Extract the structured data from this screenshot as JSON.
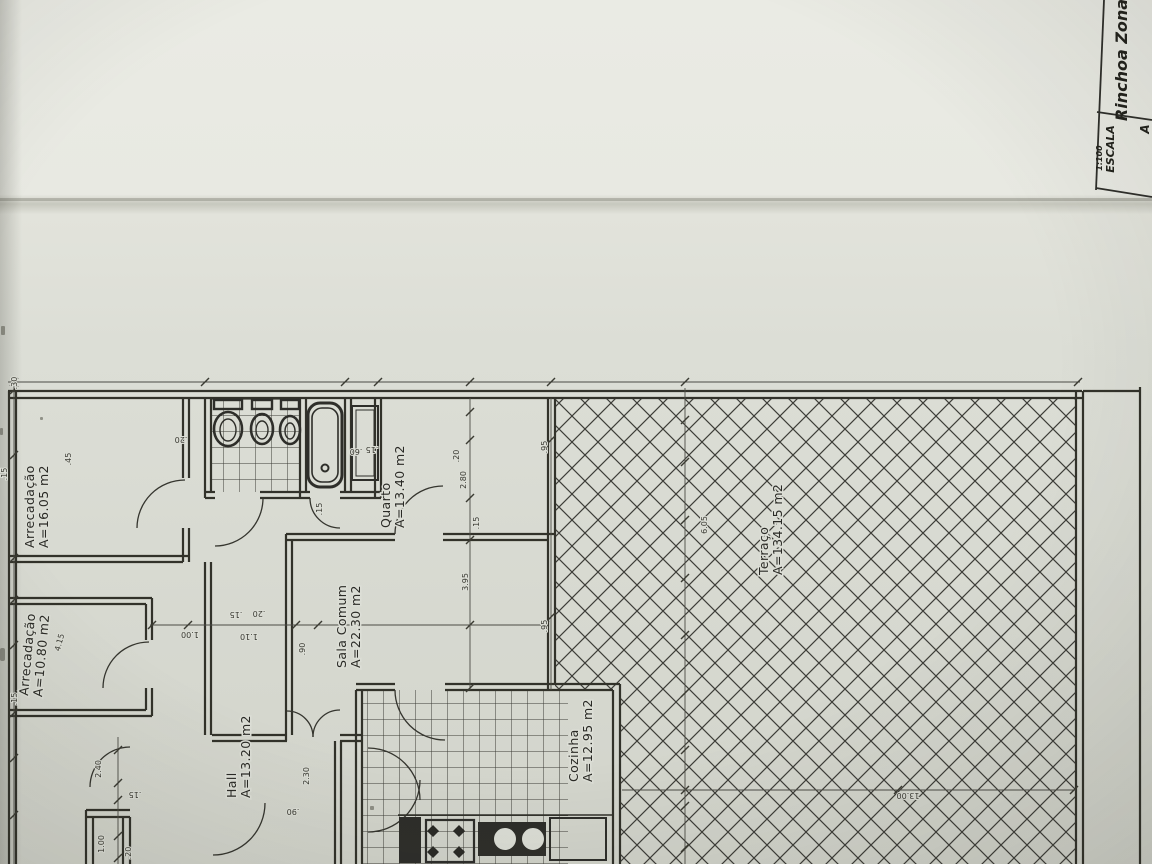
{
  "title_block": {
    "scale_label": "ESCALA",
    "scale_value": "1:100",
    "location": "Rinchoa Zona",
    "adjacent_text": "A"
  },
  "rooms": [
    {
      "name": "Arrecadação",
      "area": "A=16.05 m2",
      "x": 34,
      "y": 548,
      "r": -90
    },
    {
      "name": "Arrecadação",
      "area": "A=10.80 m2",
      "x": 28,
      "y": 696,
      "r": -85
    },
    {
      "name": "Hall",
      "area": "A=13.20 m2",
      "x": 236,
      "y": 798,
      "r": -90
    },
    {
      "name": "Sala Comum",
      "area": "A=22.30 m2",
      "x": 346,
      "y": 668,
      "r": -90
    },
    {
      "name": "Quarto",
      "area": "A=13.40 m2",
      "x": 390,
      "y": 528,
      "r": -90
    },
    {
      "name": "Cozinha",
      "area": "A=12.95 m2",
      "x": 578,
      "y": 782,
      "r": -90
    },
    {
      "name": "Terraço",
      "area": "A=134.15 m2",
      "x": 768,
      "y": 575,
      "r": -90
    }
  ],
  "dimensions": [
    {
      "t": ".30",
      "x": 17,
      "y": 383,
      "r": -90
    },
    {
      "t": ".20",
      "x": 181,
      "y": 437,
      "r": 180
    },
    {
      "t": ".60",
      "x": 356,
      "y": 449,
      "r": 180
    },
    {
      "t": ".15",
      "x": 372,
      "y": 447,
      "r": 180
    },
    {
      "t": ".20",
      "x": 459,
      "y": 456,
      "r": -90
    },
    {
      "t": "2.80",
      "x": 466,
      "y": 480,
      "r": -90
    },
    {
      "t": ".15",
      "x": 479,
      "y": 523,
      "r": -90
    },
    {
      "t": "3.95",
      "x": 468,
      "y": 582,
      "r": -90
    },
    {
      "t": ".95",
      "x": 547,
      "y": 447,
      "r": -90
    },
    {
      "t": ".95",
      "x": 547,
      "y": 626,
      "r": -90
    },
    {
      "t": ".45",
      "x": 71,
      "y": 459,
      "r": -90
    },
    {
      "t": "6.05",
      "x": 707,
      "y": 525,
      "r": -90
    },
    {
      "t": "13.00",
      "x": 908,
      "y": 793,
      "r": 180
    },
    {
      "t": "1.00",
      "x": 190,
      "y": 632,
      "r": 180
    },
    {
      "t": ".15",
      "x": 236,
      "y": 612,
      "r": 180
    },
    {
      "t": ".20",
      "x": 259,
      "y": 611,
      "r": 180
    },
    {
      "t": "1.10",
      "x": 249,
      "y": 634,
      "r": 180
    },
    {
      "t": ".90",
      "x": 305,
      "y": 649,
      "r": -90
    },
    {
      "t": "4.15",
      "x": 62,
      "y": 643,
      "r": -75
    },
    {
      "t": "2.30",
      "x": 309,
      "y": 776,
      "r": -90
    },
    {
      "t": ".90",
      "x": 293,
      "y": 809,
      "r": 180
    },
    {
      "t": "2.40",
      "x": 101,
      "y": 769,
      "r": -90
    },
    {
      "t": ".15",
      "x": 135,
      "y": 792,
      "r": 180
    },
    {
      "t": "1.00",
      "x": 104,
      "y": 844,
      "r": -90
    },
    {
      "t": ".20",
      "x": 131,
      "y": 853,
      "r": -90
    },
    {
      "t": ".15",
      "x": 7,
      "y": 474,
      "r": -90
    },
    {
      "t": ".15",
      "x": 17,
      "y": 699,
      "r": -90
    },
    {
      "t": ".15",
      "x": 322,
      "y": 509,
      "r": -90
    }
  ],
  "colors": {
    "paper_top": "#e9eae3",
    "paper_mid": "#dcded6",
    "paper_bottom": "#d2d4cb",
    "crease": "#c7c8be",
    "ink": "#30302b",
    "hatch_ink": "#3e3e39"
  }
}
